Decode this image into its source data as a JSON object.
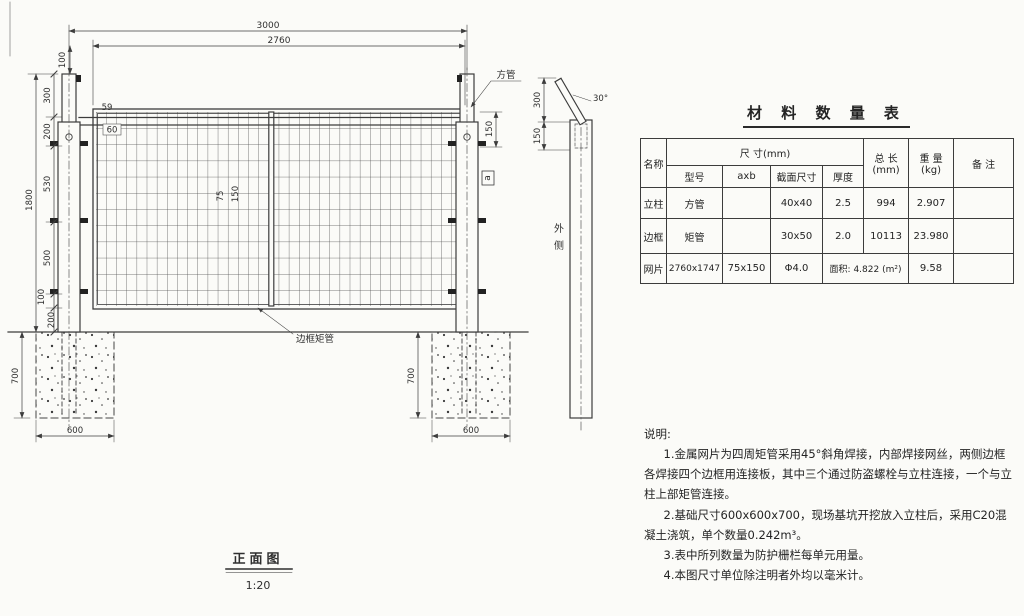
{
  "drawing": {
    "front_view": {
      "title": "正面图",
      "scale": "1:20",
      "dims": {
        "overall_width": "3000",
        "mesh_width": "2760",
        "top_offset": "100",
        "overall_height": "1800",
        "seg_300": "300",
        "seg_200": "200",
        "seg_530": "530",
        "seg_500": "500",
        "seg_100": "100",
        "seg_200b": "200",
        "d59": "59",
        "d60": "60",
        "mesh_cell_w": "75",
        "mesh_cell_h": "150",
        "post_top_150": "150",
        "foundation_depth": "700",
        "foundation_width": "600"
      },
      "labels": {
        "square_tube": "方管",
        "frame_tube": "边框矩管",
        "section_a": "a"
      }
    },
    "side_view": {
      "dims": {
        "arm_height": "300",
        "top_150": "150",
        "arm_angle": "30°"
      },
      "labels": {
        "outer_side_1": "外",
        "outer_side_2": "侧"
      }
    }
  },
  "materials_table": {
    "title": "材 料 数 量 表",
    "headers": {
      "name": "名称",
      "size_group": "尺  寸(mm)",
      "model": "型号",
      "axb": "axb",
      "section_size": "截面尺寸",
      "thickness": "厚度",
      "total_length_1": "总 长",
      "total_length_2": "(mm)",
      "weight_1": "重 量",
      "weight_2": "(kg)",
      "remark": "备 注"
    },
    "rows": [
      {
        "name": "立柱",
        "model": "方管",
        "axb": "",
        "section_size": "40x40",
        "thickness": "2.5",
        "total_length": "994",
        "weight": "2.907",
        "remark": ""
      },
      {
        "name": "边框",
        "model": "矩管",
        "axb": "",
        "section_size": "30x50",
        "thickness": "2.0",
        "total_length": "10113",
        "weight": "23.980",
        "remark": ""
      },
      {
        "name": "网片",
        "model": "2760x1747",
        "axb": "75x150",
        "section_size": "Φ4.0",
        "area": "面积: 4.822 (m²)",
        "weight": "9.58",
        "remark": ""
      }
    ]
  },
  "notes": {
    "heading": "说明:",
    "items": [
      "1.金属网片为四周矩管采用45°斜角焊接，内部焊接网丝，两侧边框各焊接四个边框用连接板，其中三个通过防盗螺栓与立柱连接，一个与立柱上部矩管连接。",
      "2.基础尺寸600x600x700，现场基坑开挖放入立柱后，采用C20混凝土浇筑，单个数量0.242m³。",
      "3.表中所列数量为防护栅栏每单元用量。",
      "4.本图尺寸单位除注明者外均以毫米计。"
    ]
  }
}
